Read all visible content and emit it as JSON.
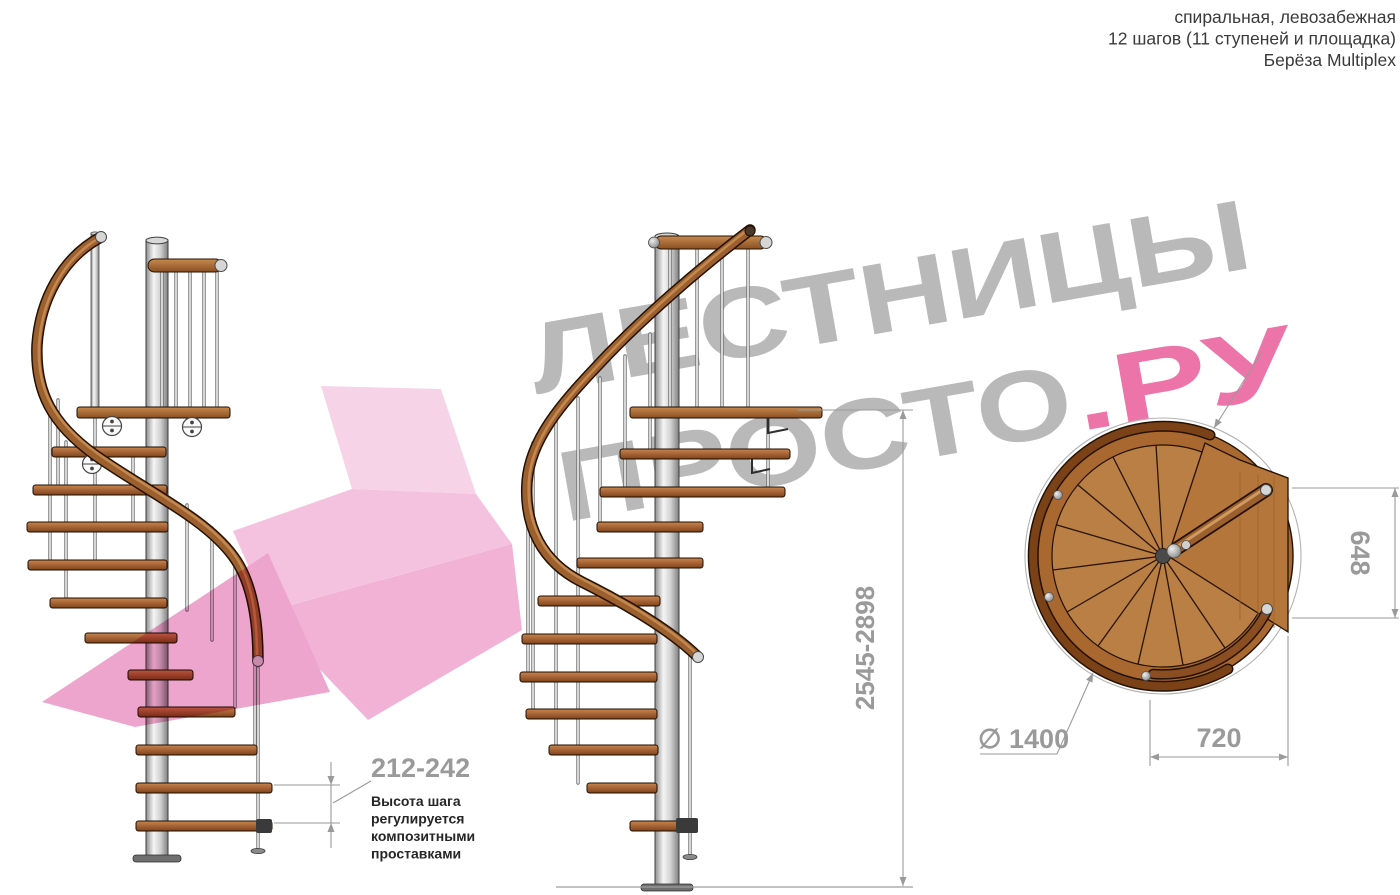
{
  "header": {
    "line1": "спиральная, левозабежная",
    "line2": "12 шагов (11 ступеней и площадка)",
    "line3": "Берёза Multiplex"
  },
  "watermark": {
    "word1": "ЛЕСТНИЦЫ",
    "word2": "ПРОСТО",
    "suffix": ".РУ"
  },
  "dimensions": {
    "step_height": {
      "value": "212-242",
      "note": [
        "Высота шага",
        "регулируется",
        "композитными",
        "проставками"
      ]
    },
    "total_height": {
      "value": "2545-2898"
    },
    "landing_side": {
      "value": "648"
    },
    "landing_width": {
      "value": "720"
    },
    "diameter": {
      "value": "∅ 1400"
    }
  },
  "colors": {
    "wm_gray": "#b9b9b9",
    "wm_pink": "#ed74a8",
    "dim": "#9a9a9a",
    "ink": "#3a3a3a",
    "note_ink": "#262626",
    "wood": "#a9663a",
    "pink_shape": "#f3b7d9"
  }
}
